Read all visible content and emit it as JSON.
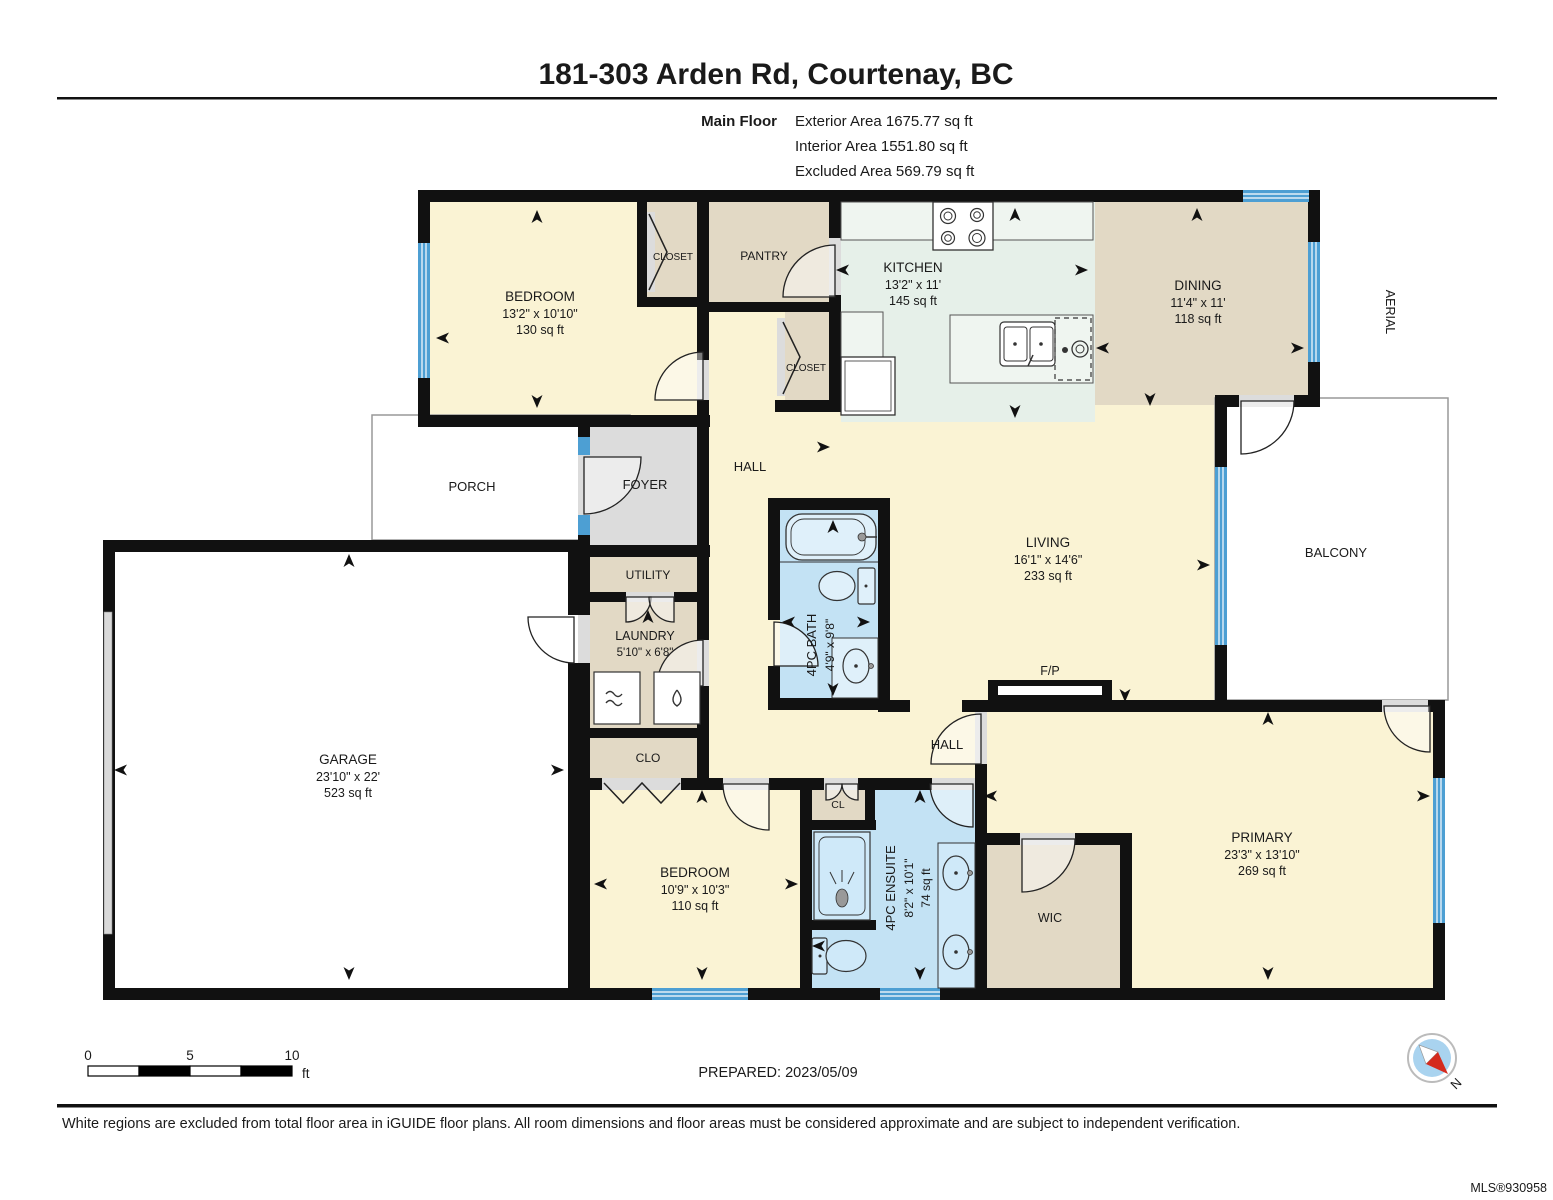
{
  "header": {
    "title": "181-303 Arden Rd, Courtenay, BC",
    "floor_label": "Main Floor",
    "area_lines": [
      "Exterior Area 1675.77 sq ft",
      "Interior Area 1551.80 sq ft",
      "Excluded Area 569.79 sq ft"
    ]
  },
  "rooms": {
    "bedroom1": {
      "label": "BEDROOM",
      "dims": "13'2\" x 10'10\"",
      "area": "130 sq ft"
    },
    "closet_top": {
      "label": "CLOSET"
    },
    "pantry": {
      "label": "PANTRY"
    },
    "closet_mid": {
      "label": "CLOSET"
    },
    "kitchen": {
      "label": "KITCHEN",
      "dims": "13'2\" x 11'",
      "area": "145 sq ft"
    },
    "dining": {
      "label": "DINING",
      "dims": "11'4\" x 11'",
      "area": "118 sq ft"
    },
    "aerial": {
      "label": "AERIAL"
    },
    "balcony": {
      "label": "BALCONY"
    },
    "porch": {
      "label": "PORCH"
    },
    "foyer": {
      "label": "FOYER"
    },
    "hall_upper": {
      "label": "HALL"
    },
    "utility": {
      "label": "UTILITY"
    },
    "laundry": {
      "label": "LAUNDRY",
      "dims": "5'10\" x 6'8\""
    },
    "bath": {
      "label": "4PC BATH",
      "dims": "4'9\" x 9'8\""
    },
    "living": {
      "label": "LIVING",
      "dims": "16'1\" x 14'6\"",
      "area": "233 sq ft"
    },
    "fireplace": {
      "label": "F/P"
    },
    "garage": {
      "label": "GARAGE",
      "dims": "23'10\" x 22'",
      "area": "523 sq ft"
    },
    "clo": {
      "label": "CLO"
    },
    "hall_lower": {
      "label": "HALL"
    },
    "cl": {
      "label": "CL"
    },
    "bedroom2": {
      "label": "BEDROOM",
      "dims": "10'9\" x 10'3\"",
      "area": "110 sq ft"
    },
    "ensuite": {
      "label": "4PC ENSUITE",
      "dims": "8'2\" x 10'1\"",
      "area": "74 sq ft"
    },
    "wic": {
      "label": "WIC"
    },
    "primary": {
      "label": "PRIMARY",
      "dims": "23'3\" x 13'10\"",
      "area": "269 sq ft"
    }
  },
  "scale_bar": {
    "tick_0": "0",
    "tick_5": "5",
    "tick_10": "10",
    "unit": "ft"
  },
  "prepared_label": "PREPARED: 2023/05/09",
  "compass": {
    "north_label": "N"
  },
  "footer": {
    "disclaimer": "White regions are excluded from total floor area in iGUIDE floor plans. All room dimensions and floor areas must be considered approximate and are subject to independent verification.",
    "mls": "MLS®930958"
  },
  "colors": {
    "wall": "#111111",
    "cream": "#FAF3D4",
    "tan": "#E2D9C5",
    "kitchen_mint": "#E6F0E9",
    "bath_blue": "#C3E2F4",
    "window_blue": "#4D9FD3",
    "foyer_gray": "#DCDCDC",
    "compass_red": "#D42B1E"
  }
}
